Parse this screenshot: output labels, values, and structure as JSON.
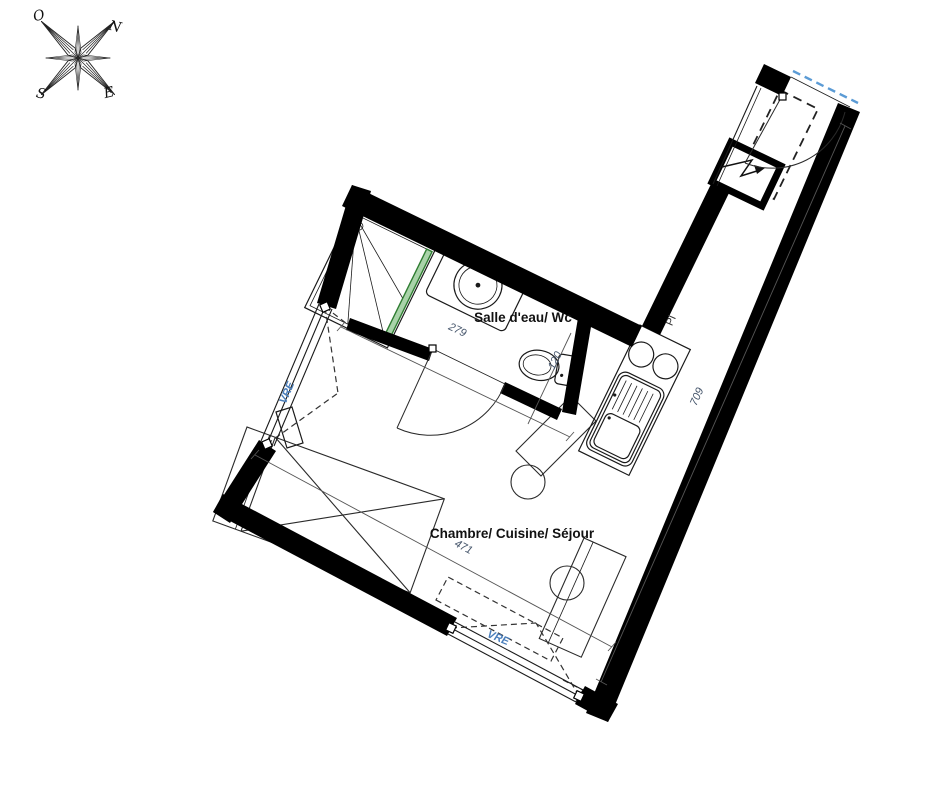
{
  "compass": {
    "o": "O",
    "n": "N",
    "s": "S",
    "e": "E"
  },
  "rooms": {
    "bathroom": {
      "label": "Salle d'eau/ Wc"
    },
    "main": {
      "label": "Chambre/ Cuisine/ Séjour"
    }
  },
  "dimensions": {
    "bathroom_width": "279",
    "bathroom_depth": "120",
    "main_width": "471",
    "right_wall": "709"
  },
  "labels": {
    "vre_left": "VRE",
    "vre_bottom": "VRE",
    "closet": "Pl"
  },
  "colors": {
    "wall": "#000000",
    "shower_screen": "#a9d3a9",
    "boundary_blue": "#5b9bd5",
    "dimension_text": "#44546a",
    "vre_text": "#4a7ebb"
  }
}
